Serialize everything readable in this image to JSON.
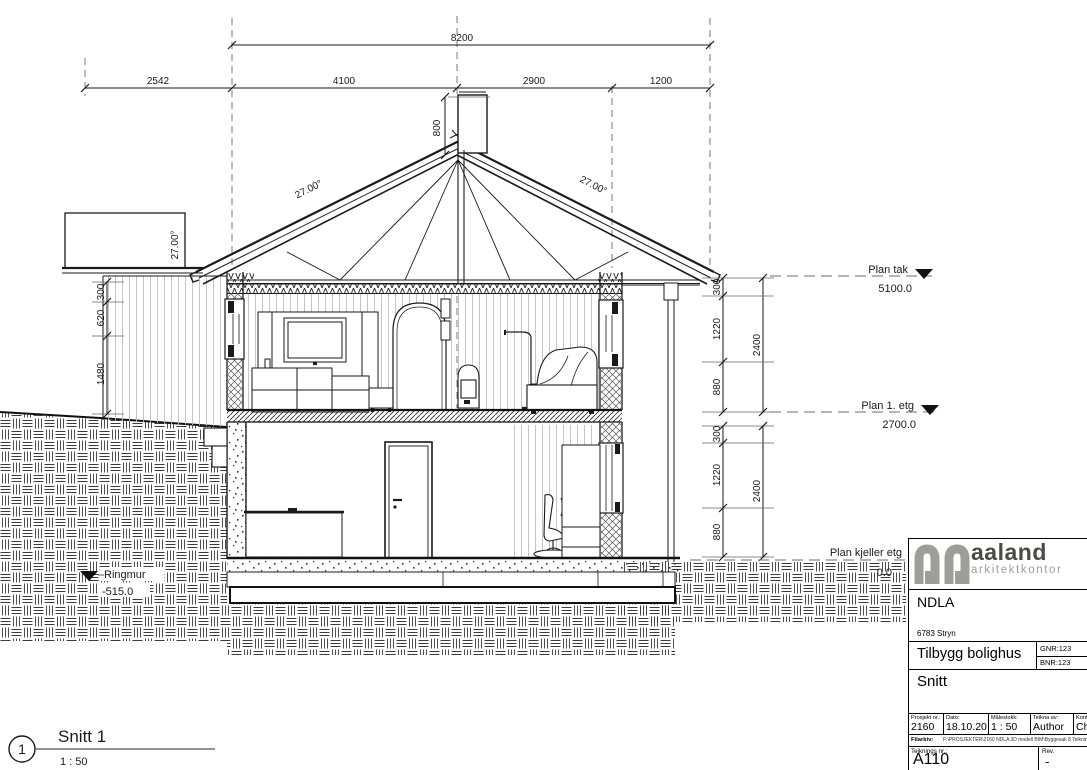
{
  "drawing": {
    "view": {
      "number": "1",
      "title": "Snitt 1",
      "scale": "1 : 50"
    },
    "dims": {
      "overall_width": "8200",
      "w1": "2542",
      "w2": "4100",
      "w3": "2900",
      "w4": "1200",
      "chimney": "800",
      "left1": "300",
      "left2": "620",
      "left3": "1480",
      "ru1": "300",
      "ru2": "1220",
      "ru3": "880",
      "ru_total": "2400",
      "rl1": "300",
      "rl2": "1220",
      "rl3": "880",
      "rl_total": "2400"
    },
    "angles": {
      "left": "27.00°",
      "right": "27.00°",
      "annex": "27.00°"
    },
    "levels": {
      "roof": {
        "label": "Plan tak",
        "value": "5100.0"
      },
      "first": {
        "label": "Plan 1. etg",
        "value": "2700.0"
      },
      "basement": {
        "label": "Plan kjeller etg",
        "value": "0.0"
      },
      "footing": {
        "label": "Ringmur",
        "value": "-515.0"
      }
    }
  },
  "title_block": {
    "logo_name": "aaland",
    "logo_subtitle": "arkitektkontor",
    "logo_color": "#9d9d9c",
    "client": "NDLA",
    "address": "6783 Stryn",
    "project": "Tilbygg bolighus",
    "gnr": "GNR:123",
    "bnr": "BNR:123",
    "drawing_title": "Snitt",
    "fields": [
      {
        "label": "Prosjekt nr.:",
        "value": "2160"
      },
      {
        "label": "Dato:",
        "value": "18.10.20"
      },
      {
        "label": "Målestokk:",
        "value": "1 : 50"
      },
      {
        "label": "Teikna av:",
        "value": "Author"
      },
      {
        "label": "Kontroll:",
        "value": "Checker"
      }
    ],
    "file_label": "Filarkiv:",
    "file_path": "F:\\PROSJEKTER\\2160 NDLA 3D modell BIM\\Byggesak 8 Teikningar...",
    "drawing_no_label": "Teiknings nr.:",
    "drawing_no": "A110",
    "rev_label": "Rev.",
    "rev": "-"
  }
}
